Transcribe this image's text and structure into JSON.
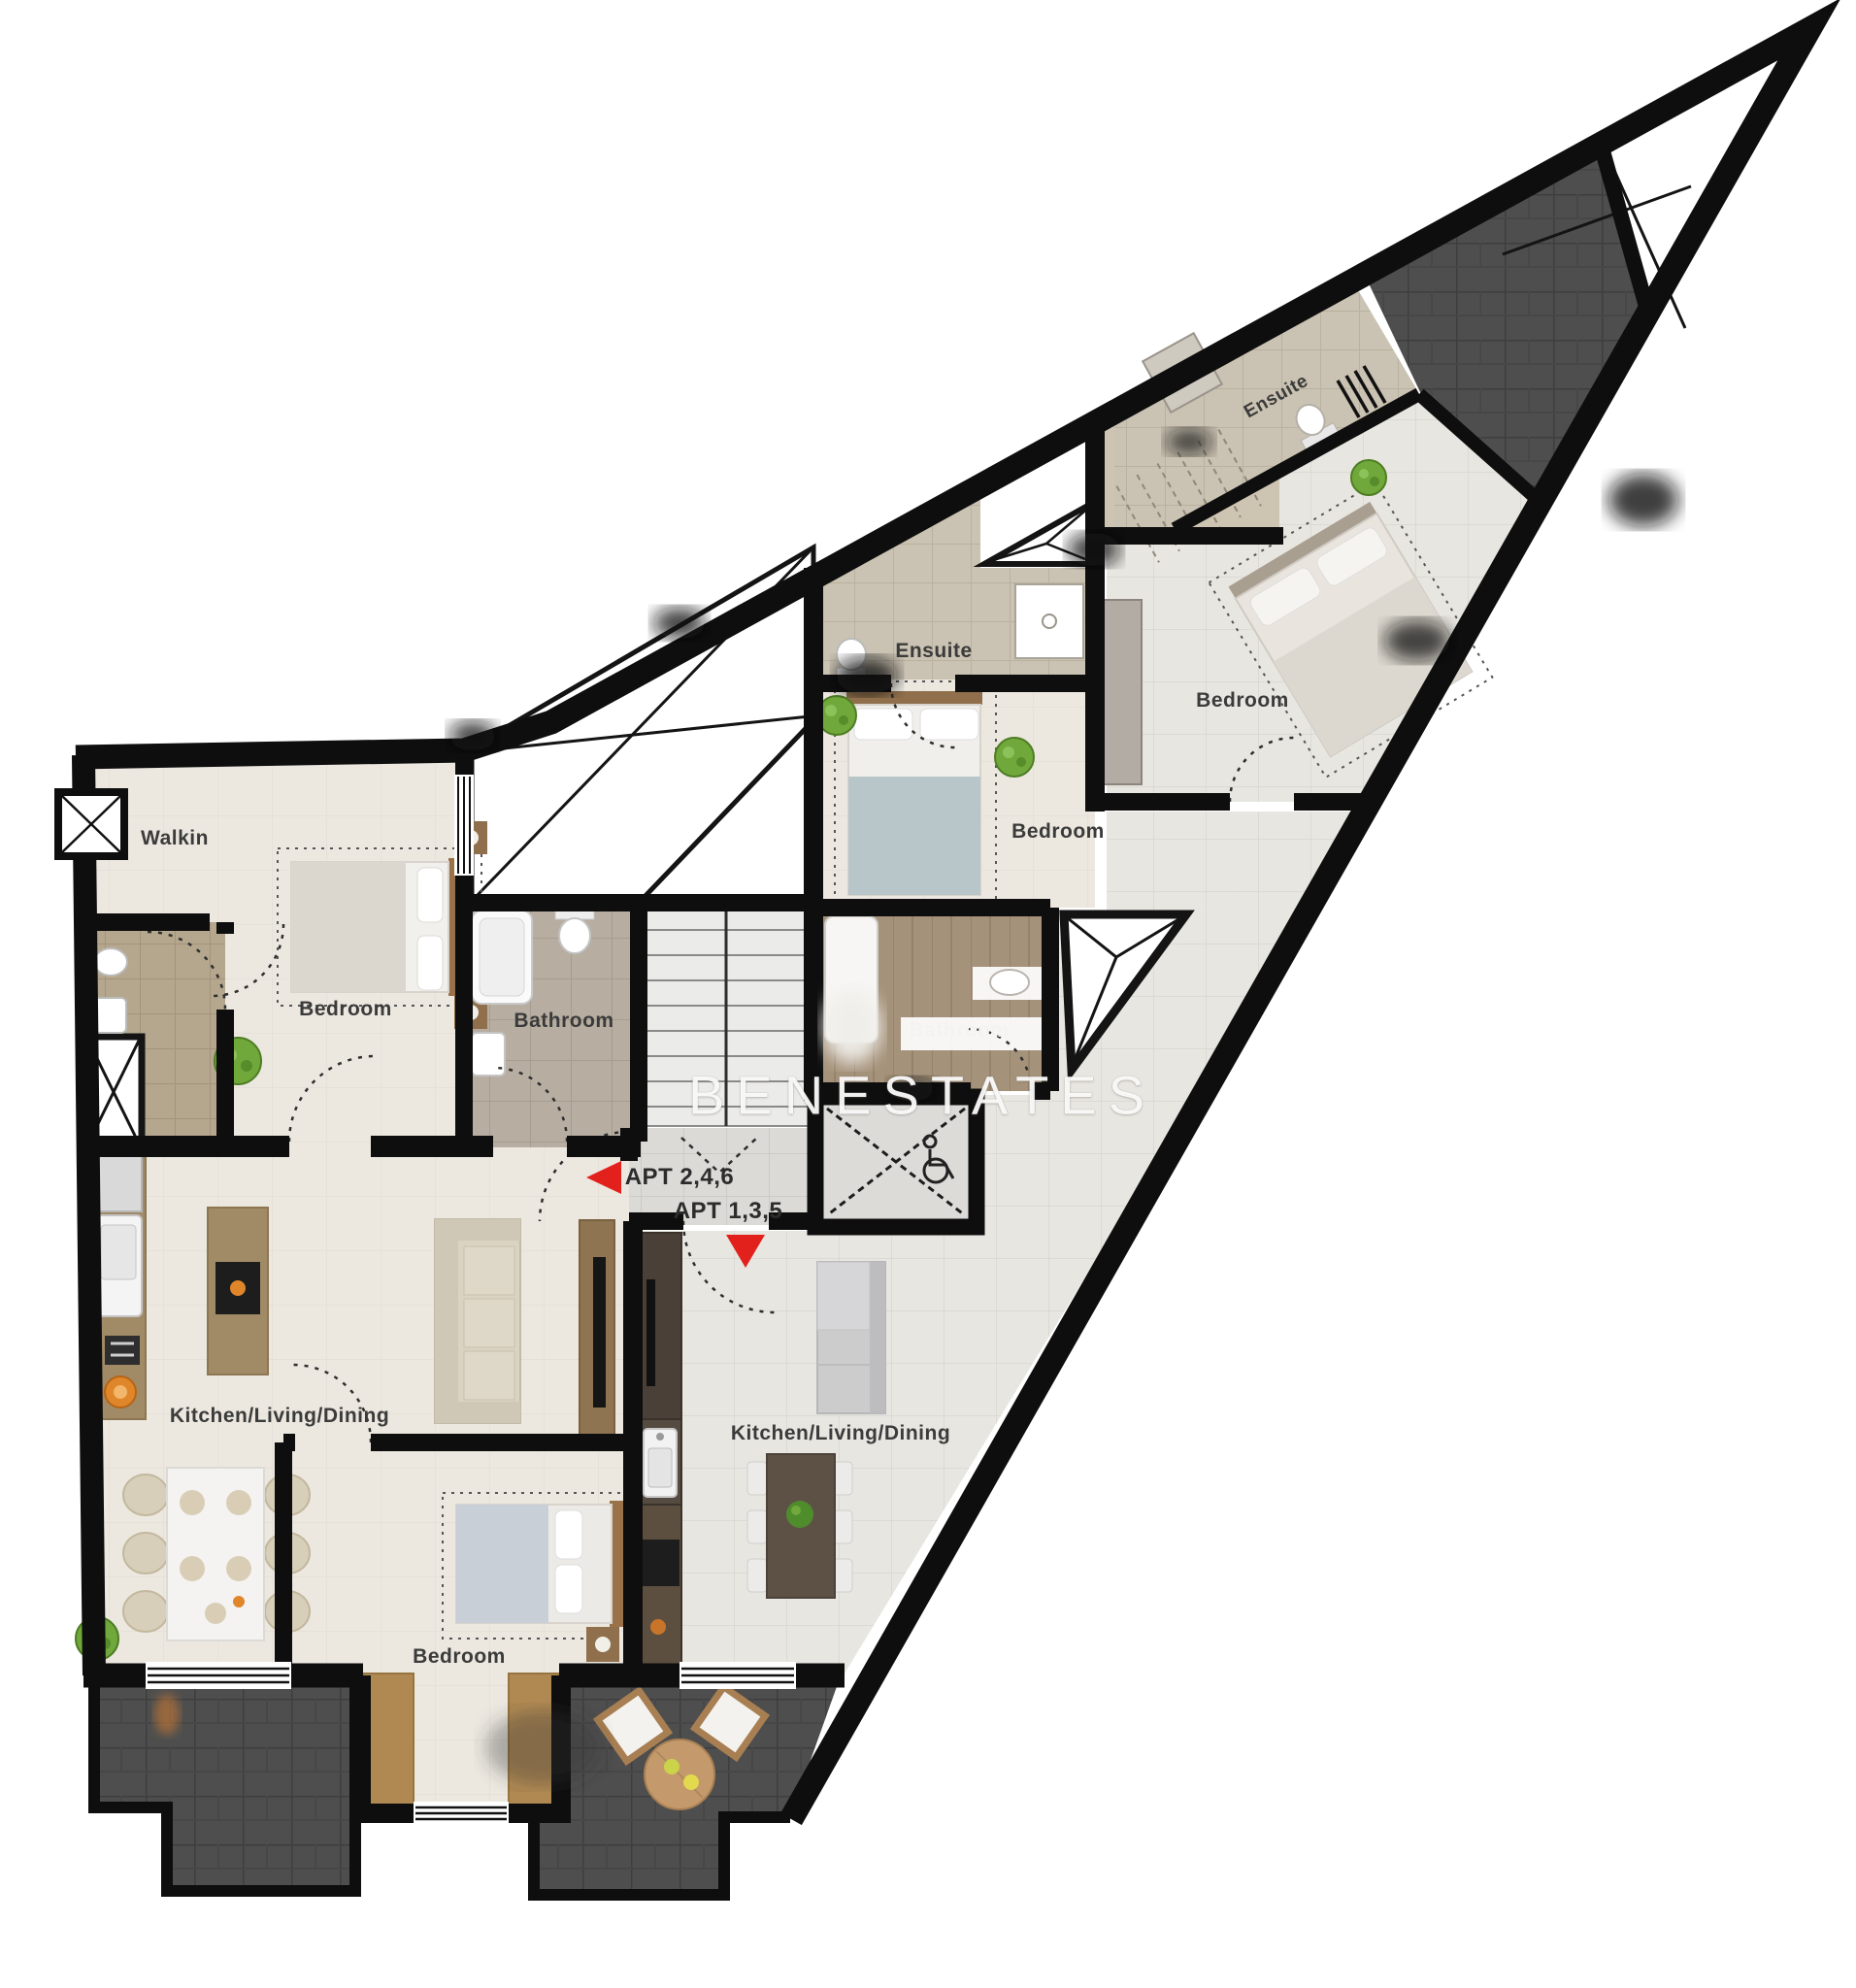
{
  "plan": {
    "watermark": "BENESTATES",
    "rooms": [
      {
        "name": "walkin",
        "label": "Walkin"
      },
      {
        "name": "bedroom-left",
        "label": "Bedroom"
      },
      {
        "name": "bathroom-central",
        "label": "Bathroom"
      },
      {
        "name": "ensuite-middle",
        "label": "Ensuite"
      },
      {
        "name": "bedroom-middle",
        "label": "Bedroom"
      },
      {
        "name": "bedroom-top-right",
        "label": "Bedroom"
      },
      {
        "name": "ensuite-top-right",
        "label": "Ensuite"
      },
      {
        "name": "bathroom-middle",
        "label": "Bathroom"
      },
      {
        "name": "kitchen-living-dining-left",
        "label": "Kitchen/Living/Dining"
      },
      {
        "name": "kitchen-living-dining-right",
        "label": "Kitchen/Living/Dining"
      },
      {
        "name": "bedroom-bottom",
        "label": "Bedroom"
      }
    ],
    "units": [
      {
        "name": "apt-2-4-6",
        "label": "APT 2,4,6",
        "arrow": "left"
      },
      {
        "name": "apt-1-3-5",
        "label": "APT 1,3,5",
        "arrow": "down"
      }
    ],
    "colors": {
      "wall": "#0e0e0e",
      "floor_cream": "#ece8e0",
      "floor_gray": "#e8e6e1",
      "terrace_dark": "#4e4e4e",
      "bathroom_tan": "#b5a78e",
      "bathroom_brown": "#a5927a",
      "accent_red": "#e3211c",
      "watermark_white": "rgba(255,255,255,0.92)"
    }
  }
}
